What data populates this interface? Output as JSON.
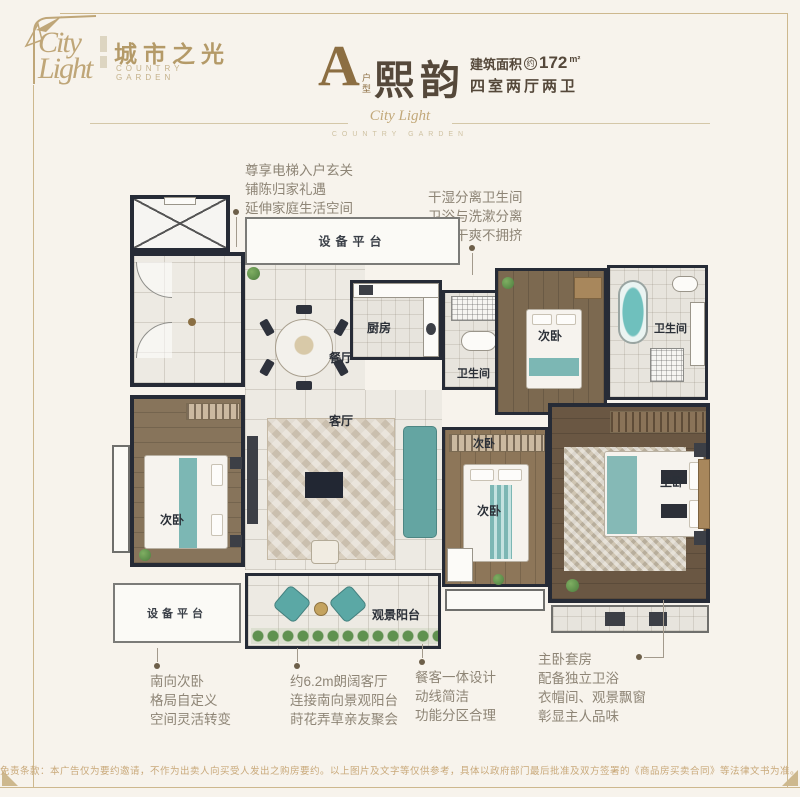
{
  "header": {
    "logo": {
      "script": "City Light",
      "brand_cn": "城市之光",
      "brand_en": "COUNTRY GARDEN"
    },
    "title": {
      "letter": "A",
      "letter_caption": "户型",
      "name": "熙韵",
      "area_label": "建筑面积",
      "area_approx": "约",
      "area_value": "172",
      "area_unit": "m²",
      "layout": "四室两厅两卫"
    }
  },
  "divider": {
    "monogram": "City Light",
    "caption": "COUNTRY GARDEN"
  },
  "callouts": {
    "top_left": {
      "lines": [
        "尊享电梯入户玄关",
        "铺陈归家礼遇",
        "延伸家庭生活空间"
      ]
    },
    "top_right": {
      "lines": [
        "干湿分离卫生间",
        "卫浴与洗漱分离",
        "清洁干爽不拥挤"
      ]
    },
    "bottom_1": {
      "lines": [
        "南向次卧",
        "格局自定义",
        "空间灵活转变"
      ]
    },
    "bottom_2": {
      "lines": [
        "约6.2m朗阔客厅",
        "连接南向景观阳台",
        "莳花弄草亲友聚会"
      ]
    },
    "bottom_3": {
      "lines": [
        "餐客一体设计",
        "动线简洁",
        "功能分区合理"
      ]
    },
    "bottom_4": {
      "lines": [
        "主卧套房",
        "配备独立卫浴",
        "衣帽间、观景飘窗",
        "彰显主人品味"
      ]
    }
  },
  "plan": {
    "labels": {
      "equip_top": "设备平台",
      "dining": "餐厅",
      "kitchen": "厨房",
      "bath_center": "卫生间",
      "bedroom_tr": "次卧",
      "bath_tr": "卫生间",
      "living": "客厅",
      "bedroom_left": "次卧",
      "bedroom_center_tag": "次卧",
      "bedroom_center": "次卧",
      "master": "主卧",
      "equip_bottom": "设备平台",
      "balcony": "观景阳台"
    }
  },
  "footer": {
    "disclaimer": "免责条款：本广告仅为要约邀请，不作为出卖人向买受人发出之购房要约。以上图片及文字等仅供参考，具体以政府部门最后批准及双方签署的《商品房买卖合同》等法律文书为准。"
  },
  "colors": {
    "accent_gold": "#8c6e42",
    "brand_gold": "#b49a68",
    "heading_brown": "#55483a",
    "callout_text": "#8e8576",
    "wall": "#262b36",
    "teal": "#6fb0ad",
    "disclaimer_tan": "#c9a97a",
    "background": "#f7f3ec"
  }
}
